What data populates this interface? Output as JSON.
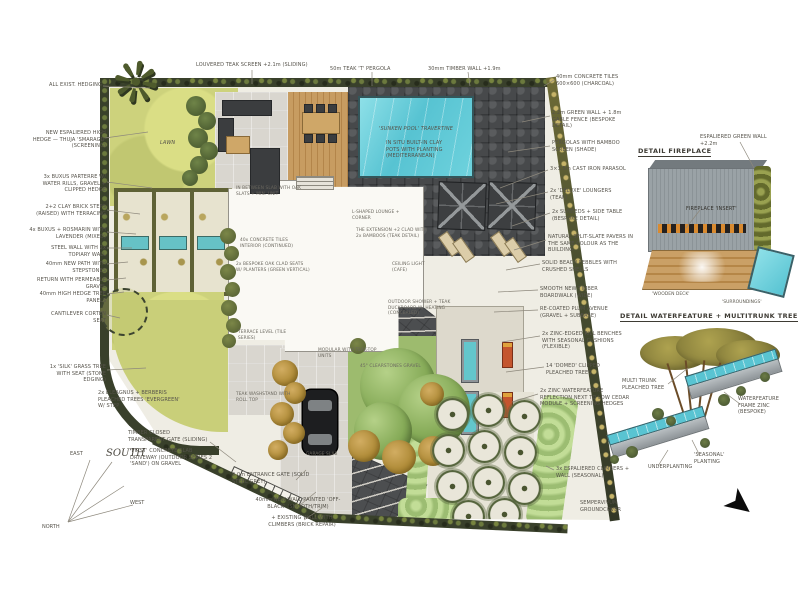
{
  "page": {
    "type": "hand-rendered landscape masterplan sketch"
  },
  "colors": {
    "pool_teal": "#5ec8d6",
    "lawn_green": "#cbd17b",
    "charcoal_tiles": "#47494b",
    "deck_wood": "#c49a5f",
    "paper": "#efede4",
    "ink": "#55524a",
    "hedge_dark": "#39402b",
    "tree_green": "#86ab58",
    "tree_ochre": "#a8842f"
  },
  "plan_labels": {
    "lawn": "LAWN",
    "pool_title": "'SUNKEN POOL' TRAVERTINE",
    "pool_note": "IN SITU BUILT-IN CLAY POTS WITH PLANTING (MEDITERRANEAN)"
  },
  "details": {
    "fireplace": {
      "title": "DETAIL FIREPLACE",
      "green_wall_note": "ESPALIERED GREEN WALL +2.2m",
      "insert_note": "FIREPLACE 'INSERT'",
      "deck_caption": "'WOODEN DECK'",
      "surround_caption": "'SURROUNDINGS'"
    },
    "waterfeature": {
      "title": "DETAIL WATERFEATURE + MULTITRUNK TREE",
      "tree_note": "MULTI TRUNK PLEACHED TREE",
      "frame_note": "WATERFEATURE FRAME ZINC (BESPOKE)",
      "planting_note": "'SEASONAL' PLANTING",
      "under_note": "UNDERPLANTING"
    }
  },
  "compass": {
    "north": "NORTH",
    "east": "EAST",
    "south": "SOUTH",
    "west": "WEST"
  },
  "annotations": [
    {
      "t": "ALL EXIST. HEDGING",
      "x": 30,
      "y": 82,
      "w": 72,
      "a": "r"
    },
    {
      "t": "NEW ESPALIERED HIGH HEDGE — THUJA 'SMARAGD' (SCREENING)",
      "x": 28,
      "y": 130,
      "w": 78,
      "a": "r"
    },
    {
      "t": "3x BUXUS PARTERRE W/ WATER RILLS, GRAVEL + CLIPPED HEDGE",
      "x": 26,
      "y": 174,
      "w": 80,
      "a": "r"
    },
    {
      "t": "2+2 CLAY BRICK STEPS (RAISED) WITH TERRACING",
      "x": 26,
      "y": 204,
      "w": 80,
      "a": "r"
    },
    {
      "t": "4x BUXUS + ROSMARIN WITH LAVENDER (MIXED)",
      "x": 26,
      "y": 227,
      "w": 80,
      "a": "r"
    },
    {
      "t": "STEEL WALL WITH 2x TOPIARY WALL",
      "x": 30,
      "y": 245,
      "w": 76,
      "a": "r"
    },
    {
      "t": "40mm NEW PATH WITH STEPSTONES",
      "x": 28,
      "y": 261,
      "w": 78,
      "a": "r"
    },
    {
      "t": "RETURN WITH PERMEABLE GRAVEL",
      "x": 34,
      "y": 277,
      "w": 72,
      "a": "r"
    },
    {
      "t": "40mm HIGH HEDGE TREE PANELS",
      "x": 30,
      "y": 291,
      "w": 76,
      "a": "r"
    },
    {
      "t": "CANTILEVER CORTEN SEAT",
      "x": 40,
      "y": 311,
      "w": 66,
      "a": "r"
    },
    {
      "t": "1x 'SILK' GRASS TREE WITH SEAT (STONE EDGING)",
      "x": 36,
      "y": 364,
      "w": 70,
      "a": "r"
    },
    {
      "t": "2x ELEAGNUS + BERBERIS PLEACHED TREES 'EVERGREEN' W/ STEP",
      "x": 98,
      "y": 390,
      "w": 86
    },
    {
      "t": "TIMBER CLOSED TRANSPARENT GATE (SLIDING)",
      "x": 128,
      "y": 430,
      "w": 80
    },
    {
      "t": "'FIRST' CONCRETE SLAB DRIVEWAY (OUTDOOR SERIES 2 'SAND') ON GRAVEL",
      "x": 130,
      "y": 448,
      "w": 86
    },
    {
      "t": "9.0m ENTRANCE GATE (SOLID STEEL GREY)",
      "x": 232,
      "y": 472,
      "w": 82
    },
    {
      "t": "40mm NEW WALL PAINTED 'OFF-BLACK' (SMOOTH/TRIM)",
      "x": 252,
      "y": 497,
      "w": 92,
      "a": "c"
    },
    {
      "t": "+ EXISTING WALL WITH CLIMBERS (BRICK REPAIR)",
      "x": 258,
      "y": 515,
      "w": 88,
      "a": "c"
    },
    {
      "t": "LOUVERED TEAK SCREEN +2.1m (SLIDING)",
      "x": 196,
      "y": 62,
      "w": 118
    },
    {
      "t": "50m TEAK 'T' PERGOLA",
      "x": 330,
      "y": 66,
      "w": 92
    },
    {
      "t": "30mm TIMBER WALL +1.9m",
      "x": 428,
      "y": 66,
      "w": 96
    },
    {
      "t": "40mm CONCRETE TILES 600×600 (CHARCOAL)",
      "x": 556,
      "y": 74,
      "w": 76
    },
    {
      "t": "2.2m GREEN WALL + 1.8m GABLE FENCE (BESPOKE DETAIL)",
      "x": 552,
      "y": 110,
      "w": 78
    },
    {
      "t": "PERGOLAS WITH BAMBOO SCREEN (SHADE)",
      "x": 552,
      "y": 140,
      "w": 76
    },
    {
      "t": "3×3.5m CAST IRON PARASOL",
      "x": 550,
      "y": 166,
      "w": 78
    },
    {
      "t": "2x 'DELUXE' LOUNGERS (TEAK)",
      "x": 550,
      "y": 188,
      "w": 78
    },
    {
      "t": "2x SUNBEDS + SIDE TABLE (BESPOKE DETAIL)",
      "x": 552,
      "y": 209,
      "w": 76
    },
    {
      "t": "NATURAL SPLIT-SLATE PAVERS IN THE SAME COLOUR AS THE BUILDING",
      "x": 548,
      "y": 234,
      "w": 86
    },
    {
      "t": "SOLID BEACH PEBBLES WITH CRUSHED SHELLS",
      "x": 542,
      "y": 260,
      "w": 84
    },
    {
      "t": "SMOOTH NEW TIMBER BOARDWALK (WIDE)",
      "x": 540,
      "y": 286,
      "w": 80
    },
    {
      "t": "RE-COATED PLUM AVENUE (GRAVEL + SUBBASE)",
      "x": 540,
      "y": 306,
      "w": 80
    },
    {
      "t": "2x ZINC-EDGED RILL BENCHES WITH SEASONAL CUSHIONS (FLEXIBLE)",
      "x": 542,
      "y": 331,
      "w": 84
    },
    {
      "t": "14 'DOMED' CLIPPED PLEACHED TREES",
      "x": 546,
      "y": 363,
      "w": 78
    },
    {
      "t": "2x ZINC WATERFEATURE REFLECTION NEXT TO LOW CEDAR MODULE + SCREENING HEDGES",
      "x": 540,
      "y": 388,
      "w": 92
    },
    {
      "t": "3x ESPALIERED CLIMBERS + WALL (SEASONAL)",
      "x": 556,
      "y": 466,
      "w": 80
    },
    {
      "t": "SEMPERVIVUM GROUNDCOVER",
      "x": 580,
      "y": 500,
      "w": 70
    },
    {
      "t": "IN BETWEEN SLAB WITH OAK SLATS + MIN. UNIT",
      "x": 236,
      "y": 186,
      "w": 78,
      "s": "xs"
    },
    {
      "t": "L-SHAPED LOUNGE + CORNER",
      "x": 352,
      "y": 210,
      "w": 60,
      "s": "xs"
    },
    {
      "t": "THE EXTENSION +2 CLAD WITH 2x BAMBOOS (TEAK DETAIL)",
      "x": 356,
      "y": 228,
      "w": 72,
      "s": "xs"
    },
    {
      "t": "40x CONCRETE TILES INTERIOR (CONTINUED)",
      "x": 240,
      "y": 238,
      "w": 66,
      "s": "xs"
    },
    {
      "t": "2x BESPOKE OAK CLAD SEATS W/ PLANTERS (GREEN VERTICAL)",
      "x": 236,
      "y": 262,
      "w": 74,
      "s": "xs"
    },
    {
      "t": "CEILING LIGHT (CAFE)",
      "x": 392,
      "y": 262,
      "w": 48,
      "s": "xs"
    },
    {
      "t": "OUTDOOR SHOWER + TEAK DUCKBOARD W/ HEATING (CONCEALED)",
      "x": 388,
      "y": 300,
      "w": 72,
      "s": "xs"
    },
    {
      "t": "TERRACE LEVEL (TILE SERIES)",
      "x": 238,
      "y": 330,
      "w": 56,
      "s": "xs"
    },
    {
      "t": "MODULAR WITH TEAK-TOP UNITS",
      "x": 318,
      "y": 348,
      "w": 70,
      "s": "xs"
    },
    {
      "t": "45° CLEARSTONES GRAVEL",
      "x": 360,
      "y": 364,
      "w": 62,
      "s": "xs"
    },
    {
      "t": "TEAK WASHSTAND WITH ROLL TOP",
      "x": 236,
      "y": 392,
      "w": 60,
      "s": "xs"
    },
    {
      "t": "GARAGE SLAB",
      "x": 306,
      "y": 452,
      "w": 40,
      "s": "xs"
    }
  ]
}
